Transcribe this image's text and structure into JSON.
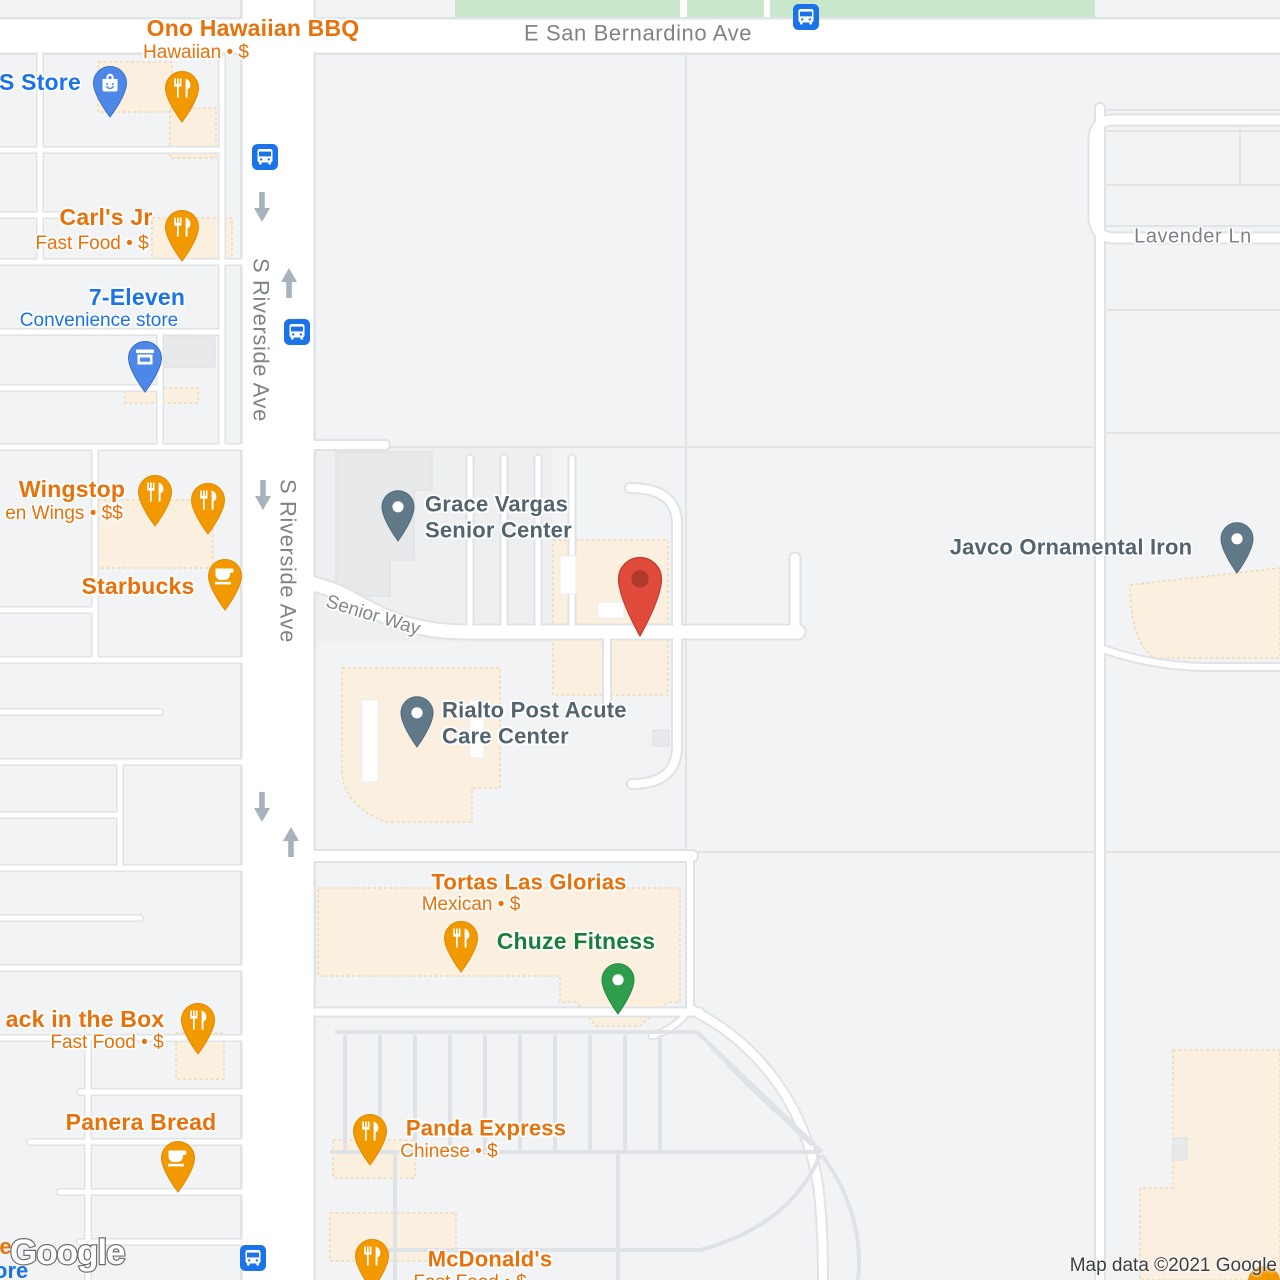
{
  "map": {
    "provider": "Google",
    "watermark": "Google",
    "attribution": "Map data ©2021 Google",
    "streets": {
      "san_bernardino": "E San Bernardino Ave",
      "riverside_1": "S Riverside Ave",
      "riverside_2": "S Riverside Ave",
      "senior_way": "Senior Way",
      "lavender": "Lavender Ln"
    },
    "pois": [
      {
        "name": "Ono Hawaiian BBQ",
        "sub": "Hawaiian • $",
        "category": "restaurant",
        "color": "orange"
      },
      {
        "name": "S Store",
        "sub": "",
        "category": "shopping",
        "color": "blue"
      },
      {
        "name": "Carl's Jr",
        "sub": "Fast Food • $",
        "category": "restaurant",
        "color": "orange"
      },
      {
        "name": "7-Eleven",
        "sub": "Convenience store",
        "category": "convenience-store",
        "color": "blue"
      },
      {
        "name": "Wingstop",
        "sub": "en Wings • $$",
        "category": "restaurant",
        "color": "orange"
      },
      {
        "name": "Starbucks",
        "sub": "",
        "category": "cafe",
        "color": "orange"
      },
      {
        "name_line1": "Grace Vargas",
        "name_line2": "Senior Center",
        "category": "community-center",
        "color": "slate"
      },
      {
        "name_line1": "Rialto Post Acute",
        "name_line2": "Care Center",
        "category": "health",
        "color": "slate"
      },
      {
        "name": "Javco Ornamental Iron",
        "sub": "",
        "category": "business",
        "color": "slate"
      },
      {
        "name": "Tortas Las Glorias",
        "sub": "Mexican • $",
        "category": "restaurant",
        "color": "orange"
      },
      {
        "name": "Chuze Fitness",
        "sub": "",
        "category": "gym",
        "color": "green"
      },
      {
        "name": "ack in the Box",
        "sub": "Fast Food • $",
        "category": "restaurant",
        "color": "orange"
      },
      {
        "name": "Panera Bread",
        "sub": "",
        "category": "cafe",
        "color": "orange"
      },
      {
        "name": "Panda Express",
        "sub": "Chinese • $",
        "category": "restaurant",
        "color": "orange"
      },
      {
        "name": "McDonald's",
        "sub": "Fast Food • $",
        "category": "restaurant",
        "color": "orange"
      }
    ],
    "unlabeled_pins": [
      {
        "category": "restaurant",
        "color": "orange"
      }
    ],
    "marker": {
      "type": "destination-marker",
      "color": "#E04B3C"
    },
    "transit": {
      "bus_stop_count": 4
    },
    "fragments": {
      "bottom_left_orange": "te",
      "bottom_left_blue": "ore"
    },
    "icons": {
      "restaurant": "fork-knife-icon",
      "cafe": "coffee-cup-icon",
      "shopping": "shopping-bag-icon",
      "convenience": "storefront-icon",
      "generic": "dot-pin-icon",
      "bus": "bus-stop-icon",
      "one_way": "one-way-arrow-icon"
    },
    "colors": {
      "orange_label": "#E8710A",
      "blue_label": "#1A73E8",
      "slate_label": "#53646F",
      "green_label": "#188038",
      "street_label": "#7E838A",
      "orange_pin": "#F29900",
      "blue_pin": "#4D87E8",
      "slate_pin": "#617A8A",
      "green_pin": "#2E9E4C",
      "red_marker": "#E04B3C",
      "bus_blue": "#1A73E8",
      "park_green": "#C9E7CA",
      "commercial_cream": "#FBEFE0",
      "road_white": "#FFFFFF",
      "base": "#F1F3F4"
    }
  }
}
